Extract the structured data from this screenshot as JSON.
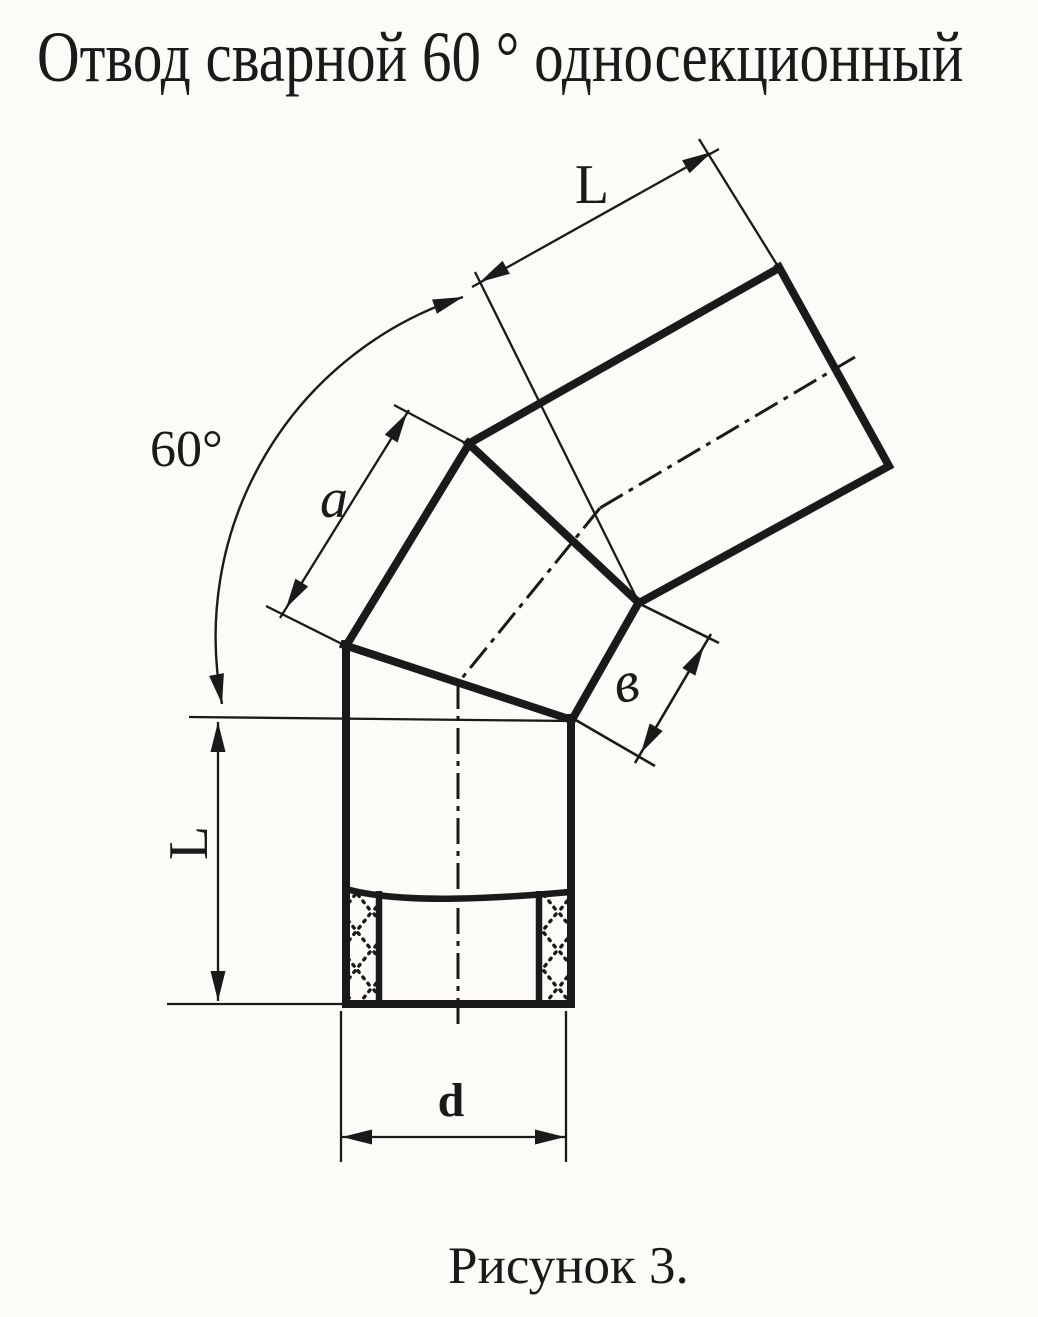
{
  "title": "Отвод сварной 60 ° односекционный",
  "caption": "Рисунок 3.",
  "labels": {
    "angle": "60°",
    "top_length": "L",
    "middle_section": "a",
    "joint_width": "в",
    "bottom_length": "L",
    "diameter": "d"
  },
  "colors": {
    "ink": "#1a1a1a",
    "paper": "#fcfbf7"
  }
}
